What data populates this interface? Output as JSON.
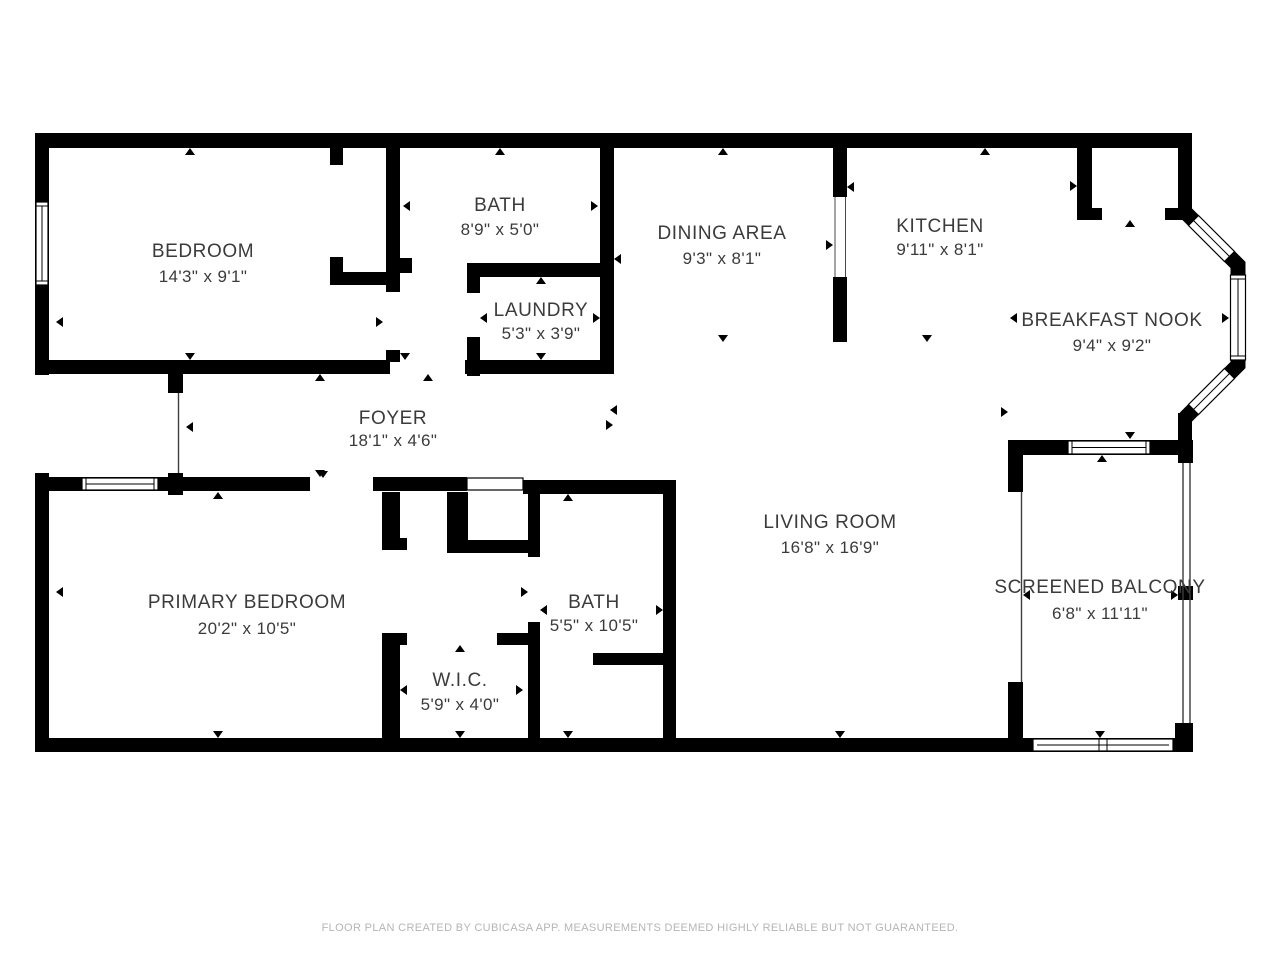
{
  "theme": {
    "wall": "#000000",
    "label": "#3b3b3b",
    "footer": "#b5b5b5",
    "bg": "#ffffff"
  },
  "rooms": {
    "bedroom": {
      "name": "BEDROOM",
      "dims": "14'3\" x 9'1\""
    },
    "bath_upper": {
      "name": "BATH",
      "dims": "8'9\" x 5'0\""
    },
    "laundry": {
      "name": "LAUNDRY",
      "dims": "5'3\" x 3'9\""
    },
    "dining": {
      "name": "DINING AREA",
      "dims": "9'3\" x 8'1\""
    },
    "kitchen": {
      "name": "KITCHEN",
      "dims": "9'11\" x 8'1\""
    },
    "breakfast_nook": {
      "name": "BREAKFAST NOOK",
      "dims": "9'4\" x 9'2\""
    },
    "foyer": {
      "name": "FOYER",
      "dims": "18'1\" x 4'6\""
    },
    "living_room": {
      "name": "LIVING ROOM",
      "dims": "16'8\" x 16'9\""
    },
    "primary_bedroom": {
      "name": "PRIMARY BEDROOM",
      "dims": "20'2\" x 10'5\""
    },
    "bath_lower": {
      "name": "BATH",
      "dims": "5'5\" x 10'5\""
    },
    "wic": {
      "name": "W.I.C.",
      "dims": "5'9\" x 4'0\""
    },
    "balcony": {
      "name": "SCREENED BALCONY",
      "dims": "6'8\" x 11'11\""
    }
  },
  "footer": {
    "text": "FLOOR PLAN CREATED BY CUBICASA APP. MEASUREMENTS DEEMED HIGHLY RELIABLE BUT NOT GUARANTEED."
  }
}
